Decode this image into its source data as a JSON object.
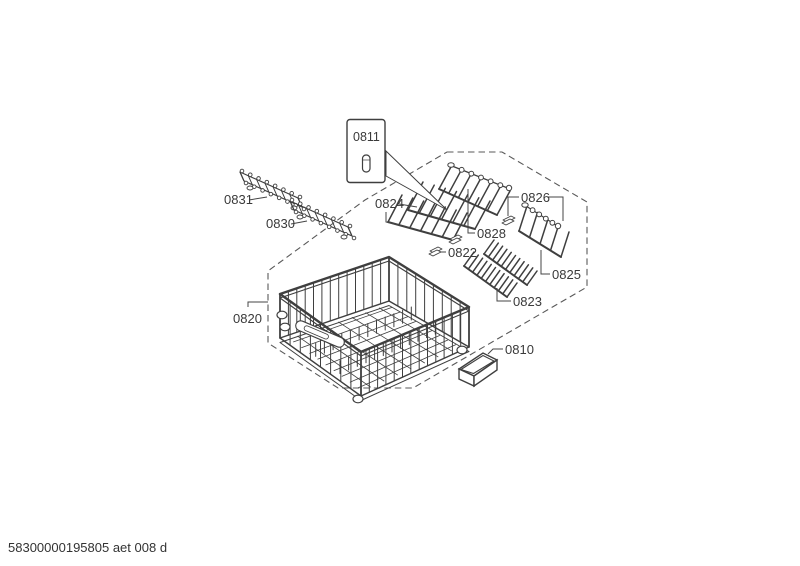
{
  "footer": {
    "code": "58300000195805 aet 008 d"
  },
  "diagram": {
    "labels": {
      "p0811": "0811",
      "p0831": "0831",
      "p0830": "0830",
      "p0824": "0824",
      "p0826": "0826",
      "p0828": "0828",
      "p0822": "0822",
      "p0825": "0825",
      "p0823": "0823",
      "p0820": "0820",
      "p0810": "0810"
    }
  }
}
